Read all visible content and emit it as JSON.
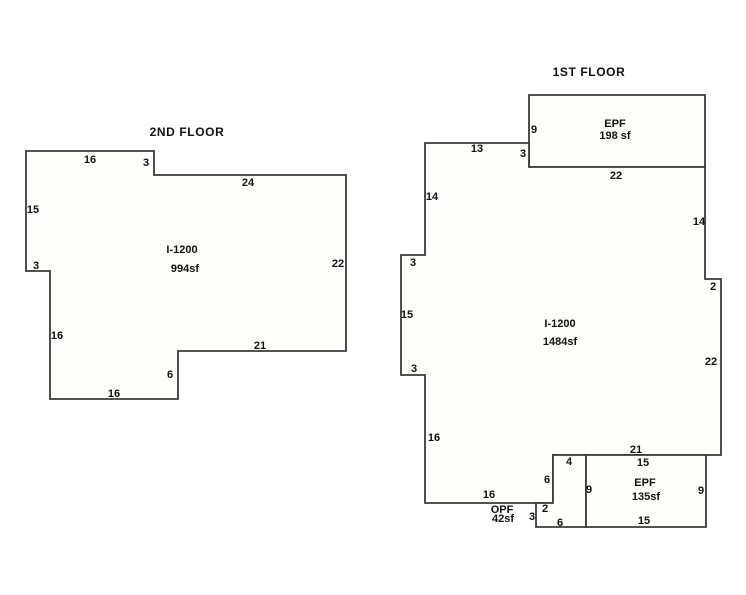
{
  "page": {
    "background_color": "#ffffff",
    "line_color": "#3b3b3b",
    "shape_fill_color": "#fffefa",
    "text_color": "#111111"
  },
  "sketch": {
    "floors": [
      {
        "id": "second-floor",
        "title": "2ND FLOOR",
        "title_pos": {
          "x": 187,
          "y": 136
        },
        "shapes": [
          {
            "name": "second-floor-outline",
            "points": "26,151 154,151 154,175 346,175 346,351 178,351 178,399 50,399 50,271 26,271"
          }
        ],
        "labels": [
          {
            "kind": "area",
            "text": "I-1200",
            "x": 182,
            "y": 253
          },
          {
            "kind": "area",
            "text": "994sf",
            "x": 185,
            "y": 272
          },
          {
            "kind": "dim",
            "text": "16",
            "x": 90,
            "y": 163
          },
          {
            "kind": "dim",
            "text": "3",
            "x": 146,
            "y": 166
          },
          {
            "kind": "dim",
            "text": "24",
            "x": 248,
            "y": 186
          },
          {
            "kind": "dim",
            "text": "22",
            "x": 338,
            "y": 267
          },
          {
            "kind": "dim",
            "text": "21",
            "x": 260,
            "y": 349
          },
          {
            "kind": "dim",
            "text": "6",
            "x": 170,
            "y": 378
          },
          {
            "kind": "dim",
            "text": "16",
            "x": 114,
            "y": 397
          },
          {
            "kind": "dim",
            "text": "16",
            "x": 57,
            "y": 339
          },
          {
            "kind": "dim",
            "text": "3",
            "x": 36,
            "y": 269
          },
          {
            "kind": "dim",
            "text": "15",
            "x": 33,
            "y": 213
          }
        ]
      },
      {
        "id": "first-floor",
        "title": "1ST FLOOR",
        "title_pos": {
          "x": 589,
          "y": 76
        },
        "shapes": [
          {
            "name": "first-floor-epf-upper",
            "points": "529,95 705,95 705,167 529,167"
          },
          {
            "name": "first-floor-outline",
            "points": "425,143 529,143 529,167 705,167 705,279 721,279 721,455 553,455 553,503 425,503 425,375 401,375 401,255 425,255"
          },
          {
            "name": "first-floor-opf",
            "points": "553,455 586,455 586,527 536,527 536,503 553,503"
          },
          {
            "name": "first-floor-epf-lower",
            "points": "586,455 706,455 706,527 586,527"
          }
        ],
        "labels": [
          {
            "kind": "area",
            "text": "EPF",
            "x": 615,
            "y": 127
          },
          {
            "kind": "area",
            "text": "198 sf",
            "x": 615,
            "y": 139
          },
          {
            "kind": "area",
            "text": "I-1200",
            "x": 560,
            "y": 327
          },
          {
            "kind": "area",
            "text": "1484sf",
            "x": 560,
            "y": 345
          },
          {
            "kind": "area",
            "text": "OPF",
            "x": 502,
            "y": 513
          },
          {
            "kind": "area",
            "text": "42sf",
            "x": 503,
            "y": 522
          },
          {
            "kind": "area",
            "text": "EPF",
            "x": 645,
            "y": 486
          },
          {
            "kind": "area",
            "text": "135sf",
            "x": 646,
            "y": 500
          },
          {
            "kind": "dim",
            "text": "9",
            "x": 534,
            "y": 133
          },
          {
            "kind": "dim",
            "text": "13",
            "x": 477,
            "y": 152
          },
          {
            "kind": "dim",
            "text": "3",
            "x": 523,
            "y": 157
          },
          {
            "kind": "dim",
            "text": "22",
            "x": 616,
            "y": 179
          },
          {
            "kind": "dim",
            "text": "14",
            "x": 432,
            "y": 200
          },
          {
            "kind": "dim",
            "text": "14",
            "x": 699,
            "y": 225
          },
          {
            "kind": "dim",
            "text": "3",
            "x": 413,
            "y": 266
          },
          {
            "kind": "dim",
            "text": "2",
            "x": 713,
            "y": 290
          },
          {
            "kind": "dim",
            "text": "15",
            "x": 407,
            "y": 318
          },
          {
            "kind": "dim",
            "text": "22",
            "x": 711,
            "y": 365
          },
          {
            "kind": "dim",
            "text": "3",
            "x": 414,
            "y": 372
          },
          {
            "kind": "dim",
            "text": "16",
            "x": 434,
            "y": 441
          },
          {
            "kind": "dim",
            "text": "21",
            "x": 636,
            "y": 453
          },
          {
            "kind": "dim",
            "text": "4",
            "x": 569,
            "y": 465
          },
          {
            "kind": "dim",
            "text": "15",
            "x": 643,
            "y": 466
          },
          {
            "kind": "dim",
            "text": "6",
            "x": 547,
            "y": 483
          },
          {
            "kind": "dim",
            "text": "9",
            "x": 589,
            "y": 493
          },
          {
            "kind": "dim",
            "text": "9",
            "x": 701,
            "y": 494
          },
          {
            "kind": "dim",
            "text": "16",
            "x": 489,
            "y": 498
          },
          {
            "kind": "dim",
            "text": "2",
            "x": 545,
            "y": 512
          },
          {
            "kind": "dim",
            "text": "3",
            "x": 532,
            "y": 520
          },
          {
            "kind": "dim",
            "text": "15",
            "x": 644,
            "y": 524
          },
          {
            "kind": "dim",
            "text": "6",
            "x": 560,
            "y": 526
          }
        ]
      }
    ]
  }
}
